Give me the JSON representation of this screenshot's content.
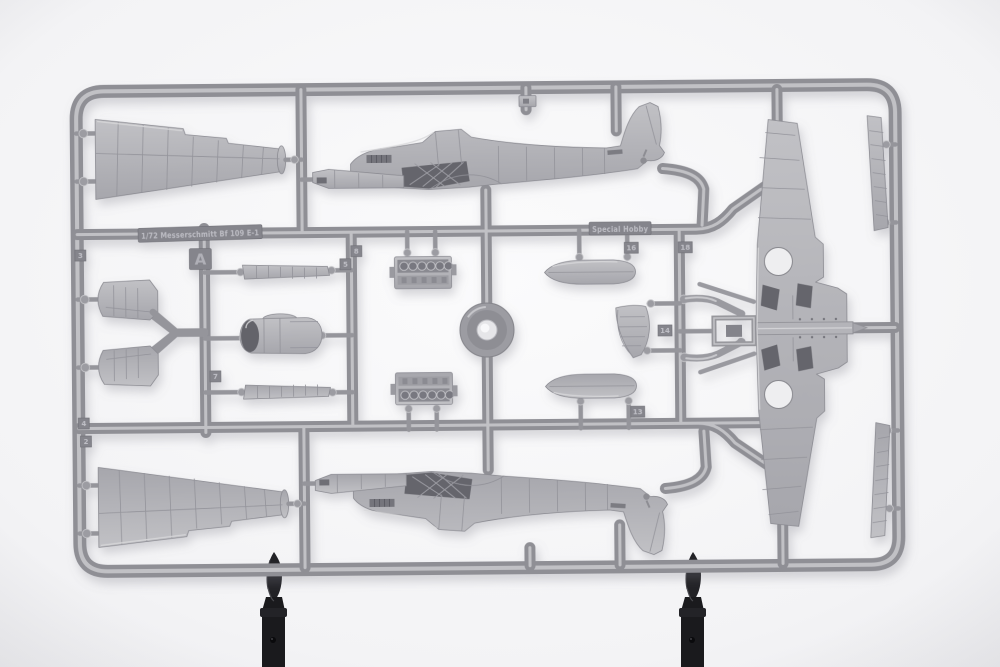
{
  "image": {
    "description": "Product photograph of a light grey injection-moulded model kit sprue (frame A) for a 1/72 Messerschmitt Bf 109 E-1 by Special Hobby, held upright by two black clips against a white background",
    "background_color": "#f4f4f5",
    "plastic_color": "#a8a8ad",
    "part_color": "#b6b6bb",
    "clip_color": "#1c1c1f"
  },
  "sprue": {
    "scale_and_type_marking": "1/72 Messerschmitt Bf 109 E-1",
    "brand_marking": "Special Hobby",
    "frame_letter": "A",
    "part_number_tags": [
      {
        "label": "3"
      },
      {
        "label": "2"
      },
      {
        "label": "4"
      },
      {
        "label": "5"
      },
      {
        "label": "8"
      },
      {
        "label": "7"
      },
      {
        "label": "16"
      },
      {
        "label": "18"
      },
      {
        "label": "14"
      },
      {
        "label": "13"
      }
    ],
    "parts": [
      "fuselage half (upper)",
      "fuselage half (lower, mirrored)",
      "one-piece wing with wheel wells",
      "wing half (top left)",
      "wing half (bottom left)",
      "horizontal stabilizer x2",
      "engine block half x2",
      "drop tank half x2",
      "engine cowling",
      "leading-edge slat strip x2",
      "flap strip x2",
      "rudder",
      "main wheel",
      "landing gear leg x2",
      "radiator housing"
    ]
  },
  "clips": {
    "count": 2,
    "description": "black spring clips holding the sprue upright"
  }
}
